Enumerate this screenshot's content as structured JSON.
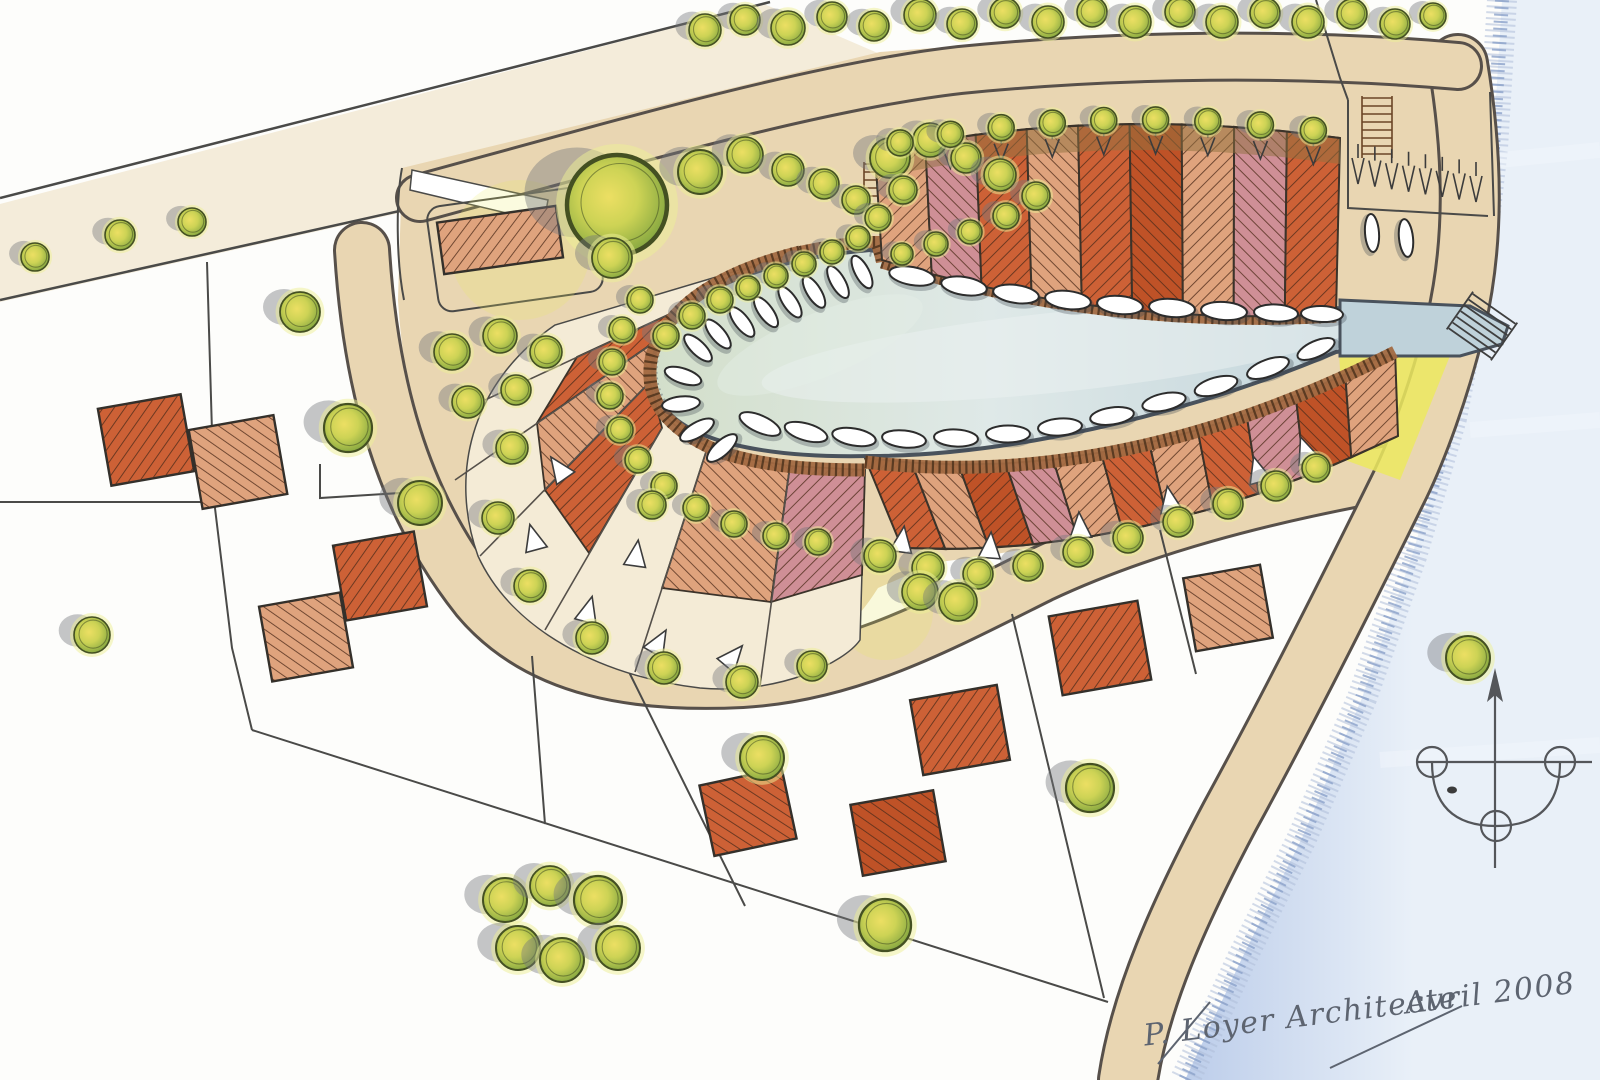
{
  "document": {
    "kind": "hand-drawn marina housing masterplan sketch",
    "signature": {
      "author": "P. Loyer Architecte",
      "date": "Avril 2008"
    }
  },
  "palette": {
    "paper": "#fdfdfb",
    "road": "#e9d6b2",
    "road_soft": "#eeddbd",
    "cream": "#f4ebd6",
    "line": "#4a4a48",
    "ring_dark": "#57504a",
    "water_w": "#d3dfca",
    "water_m": "#dfe9e8",
    "water_e": "#bfd2da",
    "water_rim": "#49525c",
    "stipple": "#55606c",
    "board": "#a26a42",
    "board_tick": "#53361f",
    "river_0": "#bccdea",
    "river_1": "#e9f0f8",
    "fringe": "#8ba1c9",
    "fringe_soft": "#aebdd9",
    "hatch_line": "#4f2c1a",
    "hatch_red": "#cd6136",
    "hatch_salmon": "#dfa37d",
    "hatch_pink": "#cf8f96",
    "hatch_deep": "#bf5227",
    "tan_strip": "#8f7140",
    "tree_core": "#ecdf63",
    "tree_mid": "#cdd355",
    "tree_edge": "#7da23e",
    "tree_outline": "#445022",
    "tree_glow": "#eef095",
    "shadow": "#74767c",
    "yellow_lawn": "#ece95f",
    "boat_hull": "#ffffff",
    "boat_line": "#2c2c2c",
    "ink": "#5d6470"
  },
  "inventory": {
    "marina_boats": 35,
    "north_terrace_plots": 9,
    "south_terrace_plots": 11,
    "crescent_wedge_plots": 5,
    "detached_houses": 10,
    "parking_stalls": 8,
    "trees": 103
  },
  "terraces": {
    "north": {
      "count": 9,
      "top": {
        "p0": [
          875,
          152
        ],
        "c": [
          1100,
          104
        ],
        "p1": [
          1340,
          138
        ]
      },
      "bottom": {
        "p0": [
          882,
          260
        ],
        "c": [
          1105,
          328
        ],
        "p1": [
          1336,
          314
        ]
      },
      "tones": [
        "salmon",
        "pink",
        "red",
        "salmon",
        "red",
        "deep",
        "salmon",
        "pink",
        "red"
      ]
    },
    "south": {
      "count": 11,
      "top": {
        "p0": [
          865,
          458
        ],
        "c": [
          1120,
          492
        ],
        "p1": [
          1395,
          350
        ]
      },
      "bottom": {
        "p0": [
          902,
          548
        ],
        "c": [
          1140,
          560
        ],
        "p1": [
          1398,
          436
        ]
      },
      "tones": [
        "red",
        "salmon",
        "deep",
        "pink",
        "salmon",
        "red",
        "salmon",
        "red",
        "pink",
        "deep",
        "salmon"
      ]
    }
  },
  "fan": {
    "wedges": [
      {
        "pts": [
          [
            726,
            288
          ],
          [
            672,
            330
          ],
          [
            537,
            423
          ],
          [
            577,
            357
          ]
        ],
        "tone": "red"
      },
      {
        "pts": [
          [
            672,
            330
          ],
          [
            650,
            382
          ],
          [
            545,
            490
          ],
          [
            537,
            423
          ]
        ],
        "tone": "salmon"
      },
      {
        "pts": [
          [
            650,
            382
          ],
          [
            662,
            428
          ],
          [
            589,
            553
          ],
          [
            545,
            490
          ]
        ],
        "tone": "red"
      },
      {
        "pts": [
          [
            706,
            452
          ],
          [
            790,
            466
          ],
          [
            771,
            602
          ],
          [
            662,
            588
          ]
        ],
        "tone": "salmon"
      },
      {
        "pts": [
          [
            790,
            466
          ],
          [
            865,
            470
          ],
          [
            862,
            575
          ],
          [
            771,
            602
          ]
        ],
        "tone": "pink"
      }
    ],
    "dividers": [
      [
        [
          726,
          288
        ],
        [
          485,
          400
        ]
      ],
      [
        [
          672,
          330
        ],
        [
          455,
          480
        ]
      ],
      [
        [
          650,
          382
        ],
        [
          480,
          556
        ]
      ],
      [
        [
          662,
          428
        ],
        [
          545,
          630
        ]
      ],
      [
        [
          706,
          452
        ],
        [
          635,
          672
        ]
      ],
      [
        [
          790,
          466
        ],
        [
          760,
          686
        ]
      ]
    ]
  },
  "houses": [
    [
      146,
      440,
      84,
      78,
      -10,
      "red"
    ],
    [
      238,
      462,
      86,
      80,
      -10,
      "salmon"
    ],
    [
      380,
      576,
      82,
      76,
      -10,
      "red"
    ],
    [
      306,
      637,
      82,
      76,
      -10,
      "salmon"
    ],
    [
      500,
      240,
      120,
      52,
      -8,
      "salmon"
    ],
    [
      748,
      812,
      84,
      72,
      -12,
      "red"
    ],
    [
      960,
      730,
      88,
      76,
      -10,
      "red"
    ],
    [
      898,
      833,
      84,
      72,
      -10,
      "deep"
    ],
    [
      1100,
      648,
      90,
      80,
      -10,
      "red"
    ],
    [
      1228,
      608,
      78,
      74,
      -10,
      "salmon"
    ]
  ],
  "boats": [
    [
      862,
      272,
      62,
      36,
      14
    ],
    [
      838,
      282,
      60,
      36,
      14
    ],
    [
      814,
      292,
      58,
      36,
      14
    ],
    [
      790,
      302,
      56,
      36,
      14
    ],
    [
      766,
      312,
      54,
      36,
      14
    ],
    [
      742,
      322,
      52,
      36,
      14
    ],
    [
      718,
      334,
      50,
      36,
      14
    ],
    [
      698,
      348,
      44,
      36,
      14
    ],
    [
      683,
      376,
      18,
      38,
      15
    ],
    [
      681,
      404,
      -6,
      38,
      15
    ],
    [
      697,
      430,
      -30,
      38,
      15
    ],
    [
      722,
      448,
      -42,
      38,
      15
    ],
    [
      760,
      424,
      24,
      44,
      17
    ],
    [
      806,
      432,
      16,
      44,
      17
    ],
    [
      854,
      437,
      10,
      44,
      17
    ],
    [
      904,
      439,
      6,
      44,
      17
    ],
    [
      956,
      438,
      3,
      44,
      17
    ],
    [
      1008,
      434,
      0,
      44,
      17
    ],
    [
      1060,
      427,
      -4,
      44,
      17
    ],
    [
      1112,
      416,
      -8,
      44,
      17
    ],
    [
      1164,
      402,
      -12,
      44,
      17
    ],
    [
      1216,
      386,
      -16,
      44,
      17
    ],
    [
      1268,
      368,
      -20,
      44,
      17
    ],
    [
      1316,
      349,
      -24,
      40,
      16
    ],
    [
      912,
      276,
      10,
      46,
      18
    ],
    [
      964,
      286,
      9,
      46,
      18
    ],
    [
      1016,
      294,
      8,
      46,
      18
    ],
    [
      1068,
      300,
      7,
      46,
      18
    ],
    [
      1120,
      305,
      6,
      46,
      18
    ],
    [
      1172,
      308,
      5,
      46,
      18
    ],
    [
      1224,
      311,
      4,
      46,
      18
    ],
    [
      1276,
      313,
      3,
      44,
      17
    ],
    [
      1322,
      314,
      2,
      42,
      16
    ],
    [
      1372,
      233,
      86,
      38,
      14
    ],
    [
      1406,
      238,
      84,
      38,
      14
    ]
  ],
  "trees": [
    [
      35,
      257,
      14
    ],
    [
      120,
      235,
      15
    ],
    [
      192,
      222,
      14
    ],
    [
      300,
      312,
      20
    ],
    [
      348,
      428,
      24
    ],
    [
      420,
      503,
      22
    ],
    [
      92,
      635,
      18
    ],
    [
      617,
      205,
      50
    ],
    [
      612,
      258,
      20
    ],
    [
      700,
      172,
      22
    ],
    [
      745,
      155,
      18
    ],
    [
      788,
      170,
      16
    ],
    [
      824,
      184,
      15
    ],
    [
      856,
      200,
      14
    ],
    [
      878,
      218,
      13
    ],
    [
      890,
      158,
      20
    ],
    [
      930,
      140,
      17
    ],
    [
      966,
      158,
      15
    ],
    [
      903,
      190,
      14
    ],
    [
      1000,
      175,
      16
    ],
    [
      1036,
      196,
      14
    ],
    [
      1006,
      216,
      13
    ],
    [
      970,
      232,
      12
    ],
    [
      936,
      244,
      12
    ],
    [
      902,
      254,
      11
    ],
    [
      858,
      238,
      12
    ],
    [
      832,
      252,
      12
    ],
    [
      804,
      264,
      12
    ],
    [
      776,
      276,
      12
    ],
    [
      748,
      288,
      12
    ],
    [
      720,
      300,
      13
    ],
    [
      692,
      316,
      13
    ],
    [
      666,
      336,
      13
    ],
    [
      640,
      300,
      13
    ],
    [
      622,
      330,
      13
    ],
    [
      612,
      362,
      13
    ],
    [
      610,
      396,
      13
    ],
    [
      620,
      430,
      13
    ],
    [
      638,
      460,
      13
    ],
    [
      664,
      486,
      13
    ],
    [
      696,
      508,
      13
    ],
    [
      734,
      524,
      13
    ],
    [
      776,
      536,
      13
    ],
    [
      818,
      542,
      13
    ],
    [
      705,
      30,
      16
    ],
    [
      745,
      20,
      15
    ],
    [
      788,
      28,
      17
    ],
    [
      832,
      17,
      15
    ],
    [
      874,
      26,
      15
    ],
    [
      920,
      15,
      16
    ],
    [
      962,
      24,
      15
    ],
    [
      1005,
      13,
      15
    ],
    [
      1048,
      22,
      16
    ],
    [
      1092,
      12,
      15
    ],
    [
      1135,
      22,
      16
    ],
    [
      1180,
      12,
      15
    ],
    [
      1222,
      22,
      16
    ],
    [
      1265,
      13,
      15
    ],
    [
      1308,
      22,
      16
    ],
    [
      1352,
      14,
      15
    ],
    [
      1395,
      24,
      15
    ],
    [
      1433,
      16,
      13
    ],
    [
      452,
      352,
      18
    ],
    [
      500,
      336,
      17
    ],
    [
      546,
      352,
      16
    ],
    [
      468,
      402,
      16
    ],
    [
      516,
      390,
      15
    ],
    [
      512,
      448,
      16
    ],
    [
      498,
      518,
      16
    ],
    [
      530,
      586,
      16
    ],
    [
      592,
      638,
      16
    ],
    [
      664,
      668,
      16
    ],
    [
      742,
      682,
      16
    ],
    [
      812,
      666,
      15
    ],
    [
      652,
      505,
      14
    ],
    [
      880,
      556,
      16
    ],
    [
      928,
      568,
      16
    ],
    [
      978,
      574,
      15
    ],
    [
      1028,
      566,
      15
    ],
    [
      1078,
      552,
      15
    ],
    [
      1128,
      538,
      15
    ],
    [
      1178,
      522,
      15
    ],
    [
      1228,
      504,
      15
    ],
    [
      1276,
      486,
      15
    ],
    [
      1316,
      468,
      14
    ],
    [
      920,
      592,
      18
    ],
    [
      958,
      602,
      19
    ],
    [
      505,
      900,
      22
    ],
    [
      550,
      886,
      20
    ],
    [
      598,
      900,
      24
    ],
    [
      518,
      948,
      22
    ],
    [
      562,
      960,
      22
    ],
    [
      618,
      948,
      22
    ],
    [
      885,
      925,
      26
    ],
    [
      762,
      758,
      22
    ],
    [
      1090,
      788,
      24
    ],
    [
      1468,
      658,
      22
    ]
  ],
  "triangles": [
    [
      560,
      470,
      -35
    ],
    [
      534,
      540,
      -15
    ],
    [
      588,
      612,
      15
    ],
    [
      658,
      644,
      30
    ],
    [
      732,
      658,
      40
    ],
    [
      636,
      556,
      8
    ],
    [
      902,
      542,
      8
    ],
    [
      990,
      548,
      4
    ],
    [
      1080,
      528,
      -4
    ],
    [
      1170,
      502,
      -10
    ],
    [
      1258,
      472,
      -16
    ],
    [
      1306,
      452,
      -20
    ]
  ],
  "parking": {
    "x0": 1358,
    "y0": 168,
    "x1": 1476,
    "y1": 186,
    "count": 8
  }
}
